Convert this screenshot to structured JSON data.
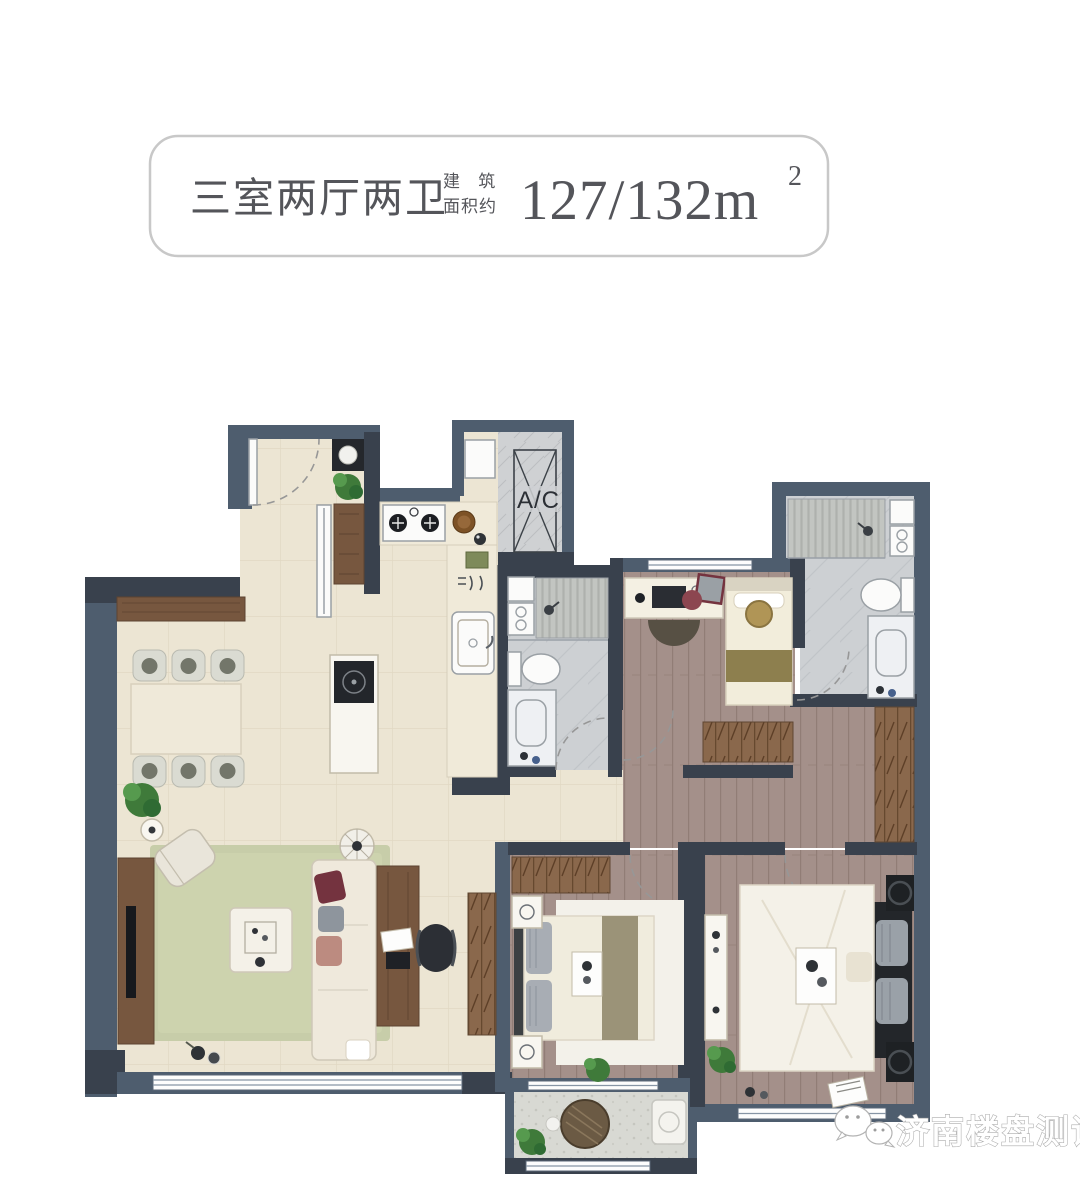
{
  "header": {
    "rooms_label": "三室两厅两卫",
    "area_label_line1": "建 筑",
    "area_label_line2": "面积约",
    "area_value": "127/132m",
    "area_superscript": "2",
    "text_color": "#54555a",
    "border_color": "#c8c8c8"
  },
  "floor_plan": {
    "ac_label": "A/C",
    "colors": {
      "wall": "#4e5d6e",
      "wall_dark": "#39414d",
      "tile_floor": "#ece5d3",
      "wood_floor": "#a4908a",
      "bath_floor": "#cdd0d3",
      "rug": "#c7cda9",
      "wood_furniture": "#77573f",
      "plant_green": "#4d8a44",
      "accent_cushion": "#74333f"
    },
    "features": [
      "entry",
      "kitchen",
      "ac-shaft",
      "dining-area",
      "living-room",
      "guest-bathroom",
      "study-bedroom",
      "hallway",
      "master-bathroom",
      "second-bedroom",
      "master-bedroom",
      "balcony"
    ]
  },
  "watermark": {
    "text": "济南楼盘测评",
    "icon": "wechat-icon",
    "color": "#ffffff"
  }
}
